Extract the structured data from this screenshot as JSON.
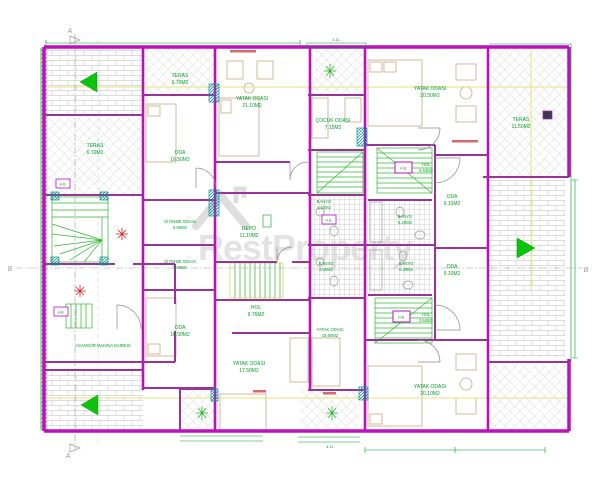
{
  "plan": {
    "watermark": {
      "text": "RestProperty"
    },
    "rooms": [
      {
        "name": "TERAS",
        "area": "6.70M2"
      },
      {
        "name": "TERAS",
        "area": "6.70M2"
      },
      {
        "name": "ODA",
        "area": "16.50M2"
      },
      {
        "name": "YATAK ODASI",
        "area": "21.10M2"
      },
      {
        "name": "ÇOCUK ODASI",
        "area": "7.15M2"
      },
      {
        "name": "YATAK ODASI",
        "area": "20.50M2"
      },
      {
        "name": "TERAS",
        "area": "11.50M2"
      },
      {
        "name": "GİYİNME ODASI",
        "area": "5.90M2"
      },
      {
        "name": "GİYİNME ODASI",
        "area": "5.90M2"
      },
      {
        "name": "ODA",
        "area": "16.50M2"
      },
      {
        "name": "DEPO",
        "area": "11.10M2"
      },
      {
        "name": "HOL",
        "area": "2.64M2"
      },
      {
        "name": "ODA",
        "area": "9.10M2"
      },
      {
        "name": "BANYO",
        "area": "4.60M2"
      },
      {
        "name": "BANYO",
        "area": "6.29M2"
      },
      {
        "name": "BANYO",
        "area": "6.29M2"
      },
      {
        "name": "ODA",
        "area": "9.10M2"
      },
      {
        "name": "HOL",
        "area": "2.64M2"
      },
      {
        "name": "HOL",
        "area": "6.75M2"
      },
      {
        "name": "YATAK ODASI",
        "area": "17.50M2"
      },
      {
        "name": "YATAK ODASI",
        "area": "15.60M2"
      },
      {
        "name": "YATAK ODASI",
        "area": "20.10M2"
      },
      {
        "name": "ASANSÖR MAKİNA DAİRESİ",
        "area": ""
      },
      {
        "name": "BANYO",
        "area": "4.60M2"
      }
    ],
    "small_labels": {
      "hb": "H.B."
    },
    "markers": {
      "section_a": "A",
      "section_b": "B"
    },
    "dimensions": {
      "balcony_top": "4.11",
      "balcony_bottom": "4.11"
    },
    "colors": {
      "wall": "#bb10bb",
      "wall_inner": "#993399",
      "label_green": "#00a028",
      "stair_green": "#2eb82e",
      "arrow_green": "#0bc40b",
      "teal": "#0b8f8f",
      "red": "#d42020",
      "hatch_gray": "#b9b9b9",
      "watermark_gray": "#e3e3e3",
      "section_yellow": "#e9e17c"
    }
  }
}
